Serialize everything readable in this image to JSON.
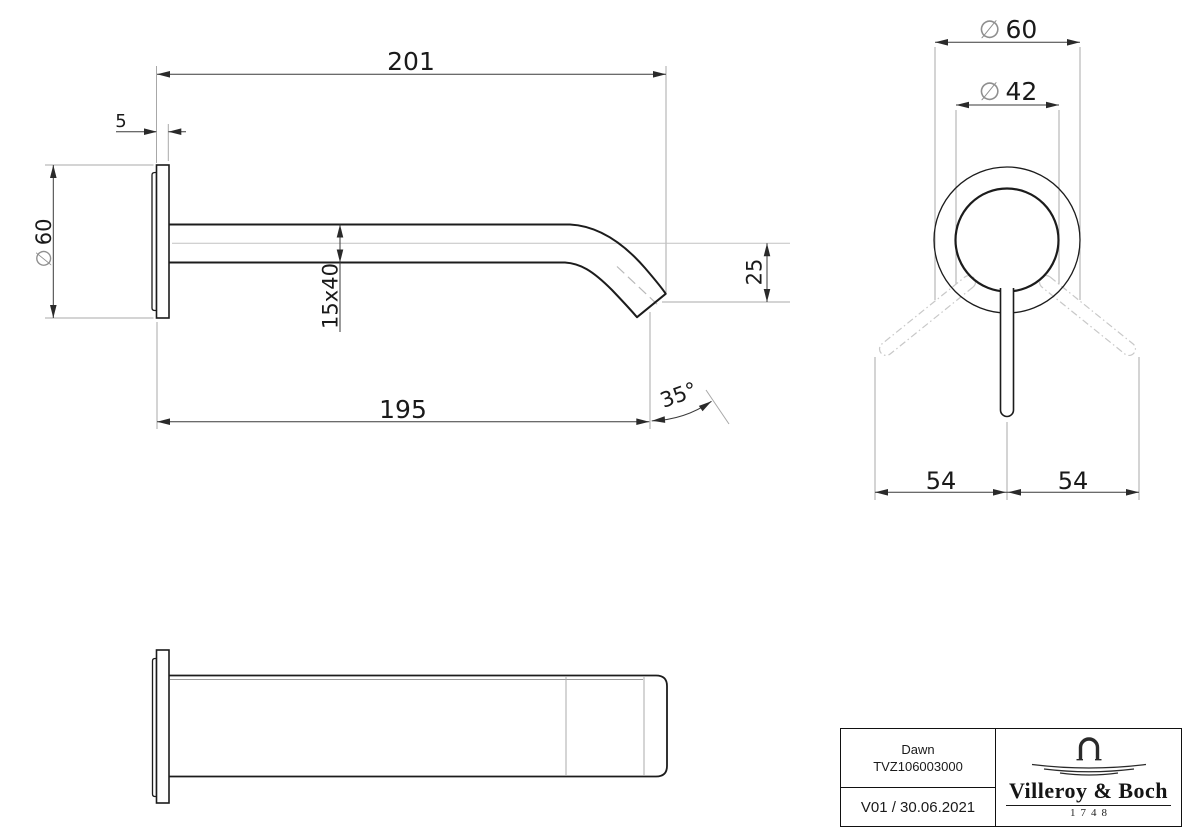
{
  "side_view": {
    "length_total": "201",
    "flange_offset": "5",
    "flange_diameter": {
      "sym": "∅",
      "val": "60"
    },
    "spout_section": "15x40",
    "outlet_drop": "25",
    "length_to_outlet": "195",
    "outlet_angle": "35°"
  },
  "front_view": {
    "escutcheon_diameter": {
      "sym": "∅",
      "val": "60"
    },
    "handle_diameter": {
      "sym": "∅",
      "val": "42"
    },
    "swing_left": "54",
    "swing_right": "54"
  },
  "title_block": {
    "product_name": "Dawn",
    "article_number": "TVZ106003000",
    "version_date": "V01 / 30.06.2021",
    "brand_name": "Villeroy & Boch",
    "brand_year": "1748"
  },
  "colors": {
    "outline": "#1c1c1c",
    "dimension": "#3a3a3a",
    "extension": "#a8a8a8",
    "centerline": "#c2c2c2",
    "phantom": "#c8c8c8"
  }
}
